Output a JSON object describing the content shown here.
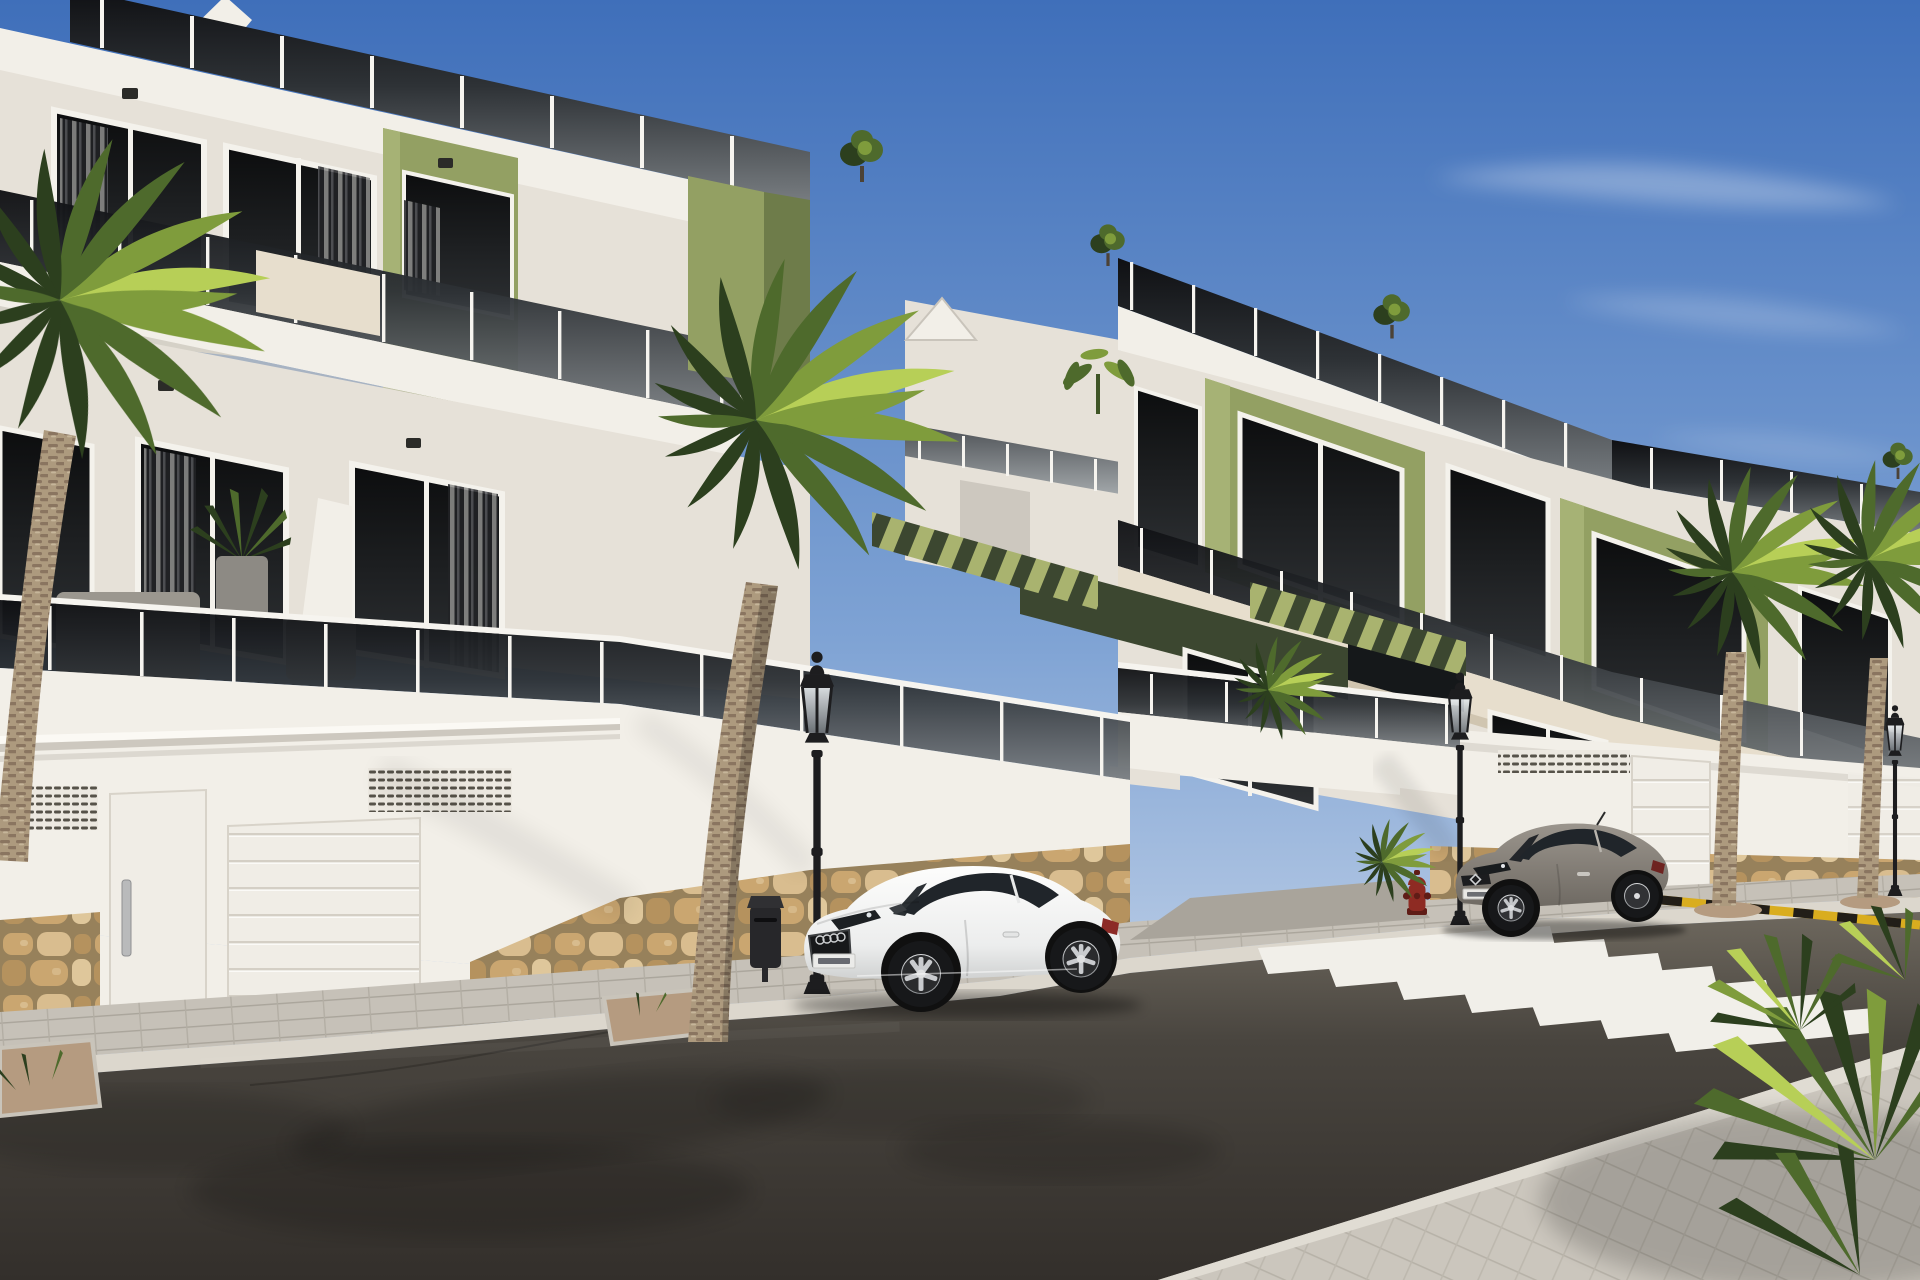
{
  "scene": {
    "type": "architectural-render",
    "description": "New-build three-storey apartment complex, white stucco with olive-green accent panels, glass balcony balustrades, garage level with sectional doors over a rubble-stone base, palm-lined street with two parked cars, classic lantern street lamps, zebra crosswalk, clear blue sky",
    "time_of_day": "daytime-sunny",
    "text_visible": "none"
  },
  "palette": {
    "sky_top": "#3f6fba",
    "sky_mid": "#7fa3d4",
    "sky_horizon": "#c9d7ea",
    "cloud": "#ffffff",
    "wall_sunlit": "#f2efe8",
    "wall_white": "#e6e1d8",
    "wall_shadow": "#cdc8bf",
    "wall_dark": "#b4afa6",
    "cream_panel": "#e7decd",
    "cream_shadow": "#d0c5b0",
    "olive_sunlit": "#93a063",
    "olive_mid": "#7d8c52",
    "olive_shadow": "#6e7c4a",
    "olive_dark": "#3c4730",
    "frame_white": "#f4f2ec",
    "post_white": "#f6f4ef",
    "window_top": "#0c0d0e",
    "window_bottom": "#2e3134",
    "rail_top": "#0f1013",
    "rail_bottom": "#7a7f83",
    "road_light": "#6e685e",
    "road_mid": "#49453f",
    "road_dark": "#332f2b",
    "sidewalk": "#c6c1b8",
    "sidewalk_shadow": "#a9a49b",
    "curb": "#dcd7cd",
    "crosswalk_white": "#f1efe9",
    "stripe_yellow": "#d9ad1f",
    "stripe_black": "#221e18",
    "lamp_black": "#1d1d1f",
    "bin_dark": "#27272a",
    "hydrant_red": "#8e2b23",
    "hydrant_dark": "#5f1c16",
    "car_white": "#fdfdfc",
    "car_white_shadow": "#cfd1d1",
    "car_glass": "#20252a",
    "car_gray": "#9b958d",
    "car_gray_dark": "#6e6962",
    "tire": "#17181a",
    "rim": "#c9cccf",
    "palm_dark": "#2c3f1e",
    "palm_mid": "#4e6a2c",
    "palm_light": "#7f9c3c",
    "palm_sun": "#b7cf57",
    "trunk_base": "#ad9a7e",
    "trunk_ring": "#8a7560",
    "gravel": "#b59b80",
    "stone_mortar": "#97815b",
    "stone_1": "#caa670",
    "stone_2": "#d9bd8f",
    "stone_3": "#b5925e",
    "stone_4": "#dfc79b"
  },
  "objects": {
    "buildings": [
      {
        "name": "left-apartment-block",
        "floors_visible": 3,
        "features": [
          "roof terrace glass balustrade",
          "olive accent panels",
          "balconies",
          "garage level",
          "stone base"
        ]
      },
      {
        "name": "right-apartment-block",
        "floors_visible": 3,
        "features": [
          "stepped roof terraces",
          "green window bays",
          "pergola slats",
          "garage level",
          "stone base"
        ]
      }
    ],
    "vehicles": [
      {
        "name": "white-coupe",
        "color_key": "car_white",
        "position": "center, parked facing left"
      },
      {
        "name": "gray-coupe",
        "color_key": "car_gray",
        "position": "right, parked facing left"
      }
    ],
    "street_furniture": [
      {
        "name": "street-lamp",
        "count": 3,
        "style": "black classic lantern"
      },
      {
        "name": "litter-bin",
        "count": 1
      },
      {
        "name": "fire-hydrant",
        "count": 1,
        "color_key": "hydrant_red"
      },
      {
        "name": "yellow-black-curb-stripe",
        "count": 1
      },
      {
        "name": "zebra-crosswalk",
        "stripes": 7
      }
    ],
    "vegetation": [
      {
        "name": "palm-tree-foreground-center",
        "count": 1
      },
      {
        "name": "palm-tree-left-edge",
        "count": 1
      },
      {
        "name": "palm-tree-right-pair",
        "count": 2
      },
      {
        "name": "yucca-corner-plant",
        "count": 1
      },
      {
        "name": "rooftop-shrubs",
        "count": 4
      },
      {
        "name": "terrace-plants",
        "count": 3
      }
    ]
  }
}
